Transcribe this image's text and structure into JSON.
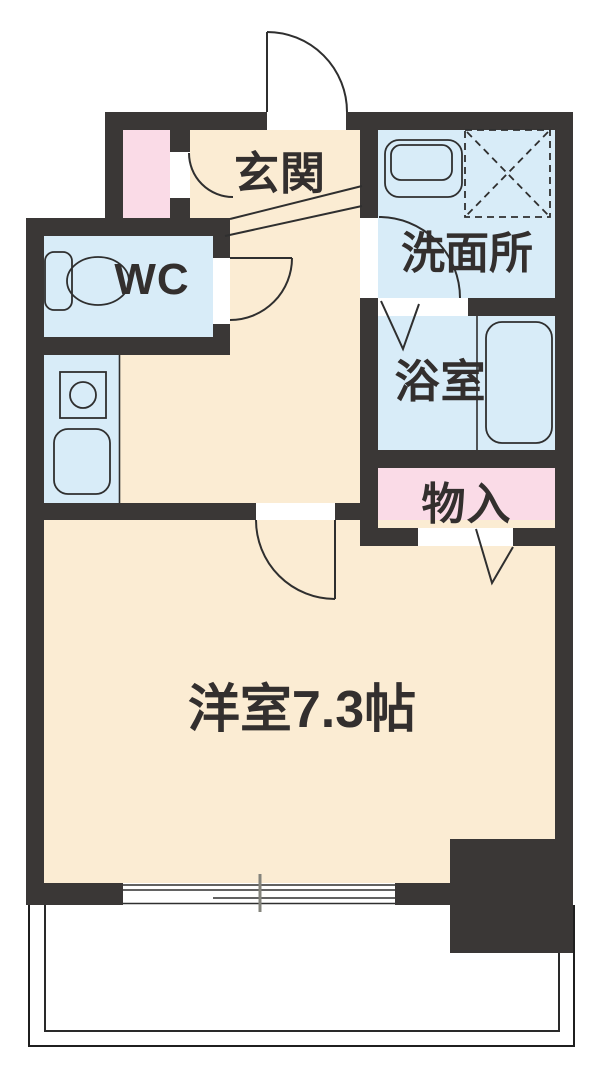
{
  "floor_plan": {
    "rooms": [
      {
        "id": "genkan",
        "label": "玄関"
      },
      {
        "id": "wc",
        "label": "WC"
      },
      {
        "id": "senmenjo",
        "label": "洗面所"
      },
      {
        "id": "yokushitsu",
        "label": "浴室"
      },
      {
        "id": "monoire",
        "label": "物入"
      },
      {
        "id": "yoshitsu",
        "label": "洋室7.3帖"
      }
    ],
    "colors": {
      "wall": "#3a3736",
      "floor": "#fbecd3",
      "wet": "#d8ecf8",
      "storage": "#fadbe7",
      "line": "#2f2f2f",
      "bg": "#ffffff"
    },
    "fixtures": [
      "entrance-door",
      "closet-door",
      "wc-door",
      "washroom-door",
      "bathroom-folding-door",
      "storage-folding-door",
      "main-room-door",
      "toilet",
      "washing-machine-pan",
      "refrigerator-space",
      "stove",
      "sink",
      "bathtub",
      "sliding-window",
      "balcony",
      "entry-step"
    ]
  }
}
